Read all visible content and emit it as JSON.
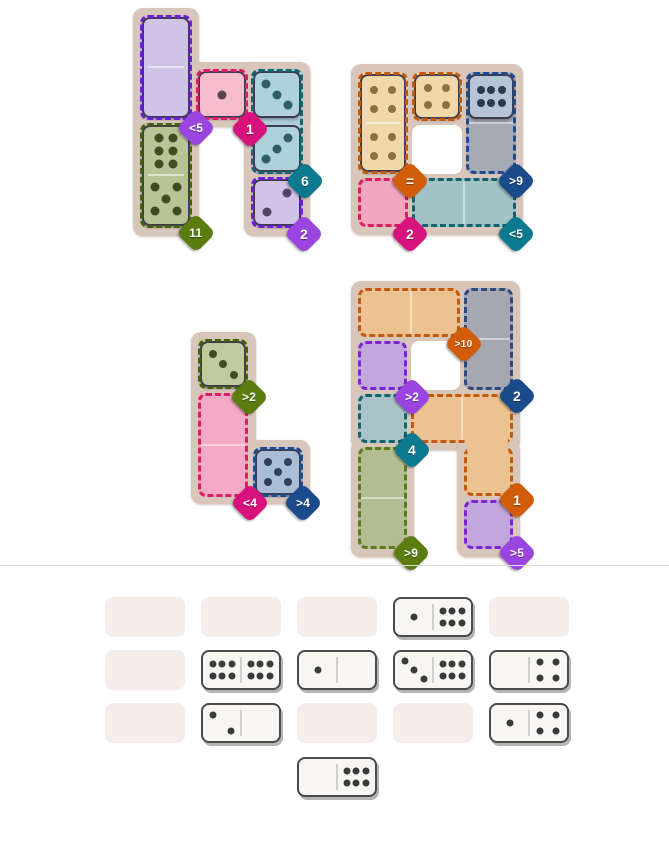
{
  "page": {
    "background": "#ffffff",
    "separator": {
      "y": 565,
      "color": "#dcdcdc"
    }
  },
  "badge_colors": {
    "purple": "#9b45e0",
    "magenta": "#d8127d",
    "teal": "#0b7a8e",
    "olive": "#5b7d10",
    "navy": "#1c4b8c",
    "orange": "#d15d0a"
  },
  "tile_outline": "#3e3a50",
  "frame_color": "#d9c6ba",
  "boards": [
    {
      "id": "top-left",
      "frame": [
        [
          133,
          8,
          66,
          228
        ],
        [
          189,
          62,
          121,
          65
        ],
        [
          244,
          62,
          66,
          174
        ]
      ],
      "regions": [
        {
          "id": "purple-top",
          "fill": "#cbbce6",
          "border": "#6d1fd0",
          "rects": [
            [
              140,
              15,
              52,
              105
            ]
          ],
          "dividers": []
        },
        {
          "id": "green",
          "fill": "#b7c293",
          "border": "#43610c",
          "rects": [
            [
              140,
              123,
              52,
              105
            ]
          ],
          "dividers": []
        },
        {
          "id": "pink",
          "fill": "#f5b3c8",
          "border": "#d81f5f",
          "rects": [
            [
              196,
              69,
              52,
              51
            ]
          ],
          "dividers": []
        },
        {
          "id": "teal",
          "fill": "#a9ced6",
          "border": "#13626e",
          "rects": [
            [
              251,
              69,
              52,
              105
            ]
          ],
          "dividers": []
        },
        {
          "id": "purple-bottom",
          "fill": "#cbbce6",
          "border": "#6d1fd0",
          "rects": [
            [
              251,
              177,
              52,
              51
            ]
          ],
          "dividers": []
        }
      ],
      "holes": [],
      "tiles": [
        {
          "x": 142,
          "y": 17,
          "w": 48,
          "h": 101,
          "fill": "#cfc3e8",
          "pip": "#4b4060",
          "divider": "h",
          "halves": [
            {
              "n": 0
            },
            {
              "n": 0
            }
          ]
        },
        {
          "x": 142,
          "y": 125,
          "w": 48,
          "h": 101,
          "fill": "#b9c396",
          "pip": "#3f4d24",
          "divider": "h",
          "halves": [
            {
              "n": 6,
              "layout": "6v"
            },
            {
              "n": 5
            }
          ]
        },
        {
          "x": 198,
          "y": 71,
          "w": 48,
          "h": 47,
          "fill": "#f6bccb",
          "pip": "#5c4150",
          "halves": [
            {
              "n": 1
            }
          ]
        },
        {
          "x": 253,
          "y": 71,
          "w": 48,
          "h": 47,
          "fill": "#add2d9",
          "pip": "#2f5f66",
          "halves": [
            {
              "n": 3
            }
          ]
        },
        {
          "x": 253,
          "y": 125,
          "w": 48,
          "h": 47,
          "fill": "#add2d9",
          "pip": "#2f5f66",
          "halves": [
            {
              "n": 3,
              "layout": "3b"
            }
          ]
        },
        {
          "x": 253,
          "y": 179,
          "w": 48,
          "h": 47,
          "fill": "#cfc3e8",
          "pip": "#514363",
          "halves": [
            {
              "n": 2,
              "layout": "2b"
            }
          ]
        }
      ],
      "badges": [
        {
          "label": "<5",
          "color": "purple",
          "x": 196,
          "y": 128
        },
        {
          "label": "1",
          "color": "magenta",
          "x": 250,
          "y": 129
        },
        {
          "label": "6",
          "color": "teal",
          "x": 305,
          "y": 181
        },
        {
          "label": "11",
          "color": "olive",
          "x": 196,
          "y": 233
        },
        {
          "label": "2",
          "color": "purple",
          "x": 304,
          "y": 234
        }
      ]
    },
    {
      "id": "top-right",
      "frame": [
        [
          351,
          64,
          172,
          171
        ]
      ],
      "regions": [
        {
          "id": "tan-left",
          "fill": "#eed6a4",
          "border": "#c05a10",
          "rects": [
            [
              358,
              72,
              50,
              102
            ]
          ],
          "dividers": []
        },
        {
          "id": "tan-top",
          "fill": "#eed6a4",
          "border": "#c05a10",
          "rects": [
            [
              412,
              72,
              50,
              49
            ]
          ],
          "dividers": []
        },
        {
          "id": "slate",
          "fill": "#a6aab5",
          "border": "#1d4b8f",
          "rects": [
            [
              466,
              72,
              50,
              102
            ]
          ],
          "dividers": [
            [
              468,
              122,
              46,
              2
            ]
          ]
        },
        {
          "id": "pink",
          "fill": "#f2a7c0",
          "border": "#d81f5f",
          "rects": [
            [
              358,
              178,
              50,
              49
            ]
          ],
          "dividers": []
        },
        {
          "id": "teal",
          "fill": "#a2c3c5",
          "border": "#13626e",
          "rects": [
            [
              412,
              178,
              104,
              49
            ]
          ],
          "dividers": [
            [
              463,
              181,
              2,
              43
            ]
          ]
        }
      ],
      "holes": [
        [
          412,
          125,
          50,
          49
        ]
      ],
      "tiles": [
        {
          "x": 360,
          "y": 74,
          "w": 46,
          "h": 98,
          "fill": "#f0d9a8",
          "pip": "#8a7243",
          "divider": "h",
          "halves": [
            {
              "n": 4
            },
            {
              "n": 4
            }
          ]
        },
        {
          "x": 414,
          "y": 74,
          "w": 46,
          "h": 45,
          "fill": "#f0d9a8",
          "pip": "#8a7243",
          "halves": [
            {
              "n": 4
            }
          ]
        },
        {
          "x": 468,
          "y": 74,
          "w": 46,
          "h": 45,
          "fill": "#b6c4d8",
          "pip": "#2c3a50",
          "halves": [
            {
              "n": 6,
              "layout": "6h"
            }
          ]
        }
      ],
      "badges": [
        {
          "label": "=",
          "color": "orange",
          "x": 410,
          "y": 181
        },
        {
          "label": ">9",
          "color": "navy",
          "x": 516,
          "y": 181
        },
        {
          "label": "2",
          "color": "magenta",
          "x": 410,
          "y": 234
        },
        {
          "label": "<5",
          "color": "teal",
          "x": 516,
          "y": 234
        }
      ]
    },
    {
      "id": "mid-left",
      "frame": [
        [
          191,
          332,
          65,
          172
        ],
        [
          246,
          440,
          64,
          64
        ]
      ],
      "regions": [
        {
          "id": "green",
          "fill": "#bdc79c",
          "border": "#43610c",
          "rects": [
            [
              198,
              339,
              50,
              50
            ]
          ],
          "dividers": []
        },
        {
          "id": "pink",
          "fill": "#f4a9c4",
          "border": "#d81f5f",
          "rects": [
            [
              198,
              393,
              50,
              104
            ]
          ],
          "dividers": [
            [
              200,
              444,
              46,
              2
            ]
          ]
        },
        {
          "id": "blue",
          "fill": "#a9bcd5",
          "border": "#1c4b8c",
          "rects": [
            [
              253,
              447,
              50,
              50
            ]
          ],
          "dividers": []
        }
      ],
      "holes": [],
      "tiles": [
        {
          "x": 200,
          "y": 341,
          "w": 46,
          "h": 46,
          "fill": "#bfcaa0",
          "pip": "#3f4d24",
          "halves": [
            {
              "n": 3
            }
          ]
        },
        {
          "x": 255,
          "y": 449,
          "w": 46,
          "h": 46,
          "fill": "#aabdd6",
          "pip": "#333f58",
          "halves": [
            {
              "n": 5
            }
          ]
        }
      ],
      "badges": [
        {
          "label": ">2",
          "color": "olive",
          "x": 249,
          "y": 397
        },
        {
          "label": "<4",
          "color": "magenta",
          "x": 250,
          "y": 503
        },
        {
          "label": ">4",
          "color": "navy",
          "x": 303,
          "y": 503
        }
      ]
    },
    {
      "id": "mid-right",
      "frame": [
        [
          351,
          281,
          169,
          169
        ],
        [
          351,
          440,
          63,
          117
        ],
        [
          457,
          440,
          63,
          117
        ]
      ],
      "regions": [
        {
          "id": "orange-top",
          "fill": "#edc291",
          "border": "#c05a10",
          "rects": [
            [
              358,
              288,
              102,
              49
            ]
          ],
          "dividers": [
            [
              410,
              291,
              2,
              43
            ]
          ]
        },
        {
          "id": "slate",
          "fill": "#a7a7b4",
          "border": "#2d4a7a",
          "rects": [
            [
              464,
              288,
              49,
              102
            ]
          ],
          "dividers": [
            [
              466,
              338,
              45,
              2
            ]
          ]
        },
        {
          "id": "purple-left",
          "fill": "#c2a7dc",
          "border": "#7d22d4",
          "rects": [
            [
              358,
              341,
              49,
              49
            ]
          ],
          "dividers": []
        },
        {
          "id": "teal",
          "fill": "#a8c4c8",
          "border": "#13626e",
          "rects": [
            [
              358,
              394,
              49,
              49
            ]
          ],
          "dividers": []
        },
        {
          "id": "orange-lower",
          "fill": "#edc291",
          "border": "#c05a10",
          "rects": [
            [
              411,
              394,
              102,
              49
            ],
            [
              464,
              447,
              49,
              49
            ]
          ],
          "dividers": [
            [
              461,
              397,
              2,
              43
            ]
          ],
          "patch": [
            467,
            438,
            41,
            14
          ]
        },
        {
          "id": "green",
          "fill": "#b4bd92",
          "border": "#5a7a1e",
          "rects": [
            [
              358,
              447,
              49,
              102
            ]
          ],
          "dividers": [
            [
              360,
              497,
              45,
              2
            ]
          ]
        },
        {
          "id": "purple-bottom",
          "fill": "#c2a7dc",
          "border": "#7d22d4",
          "rects": [
            [
              464,
              500,
              49,
              49
            ]
          ],
          "dividers": []
        }
      ],
      "holes": [
        [
          411,
          341,
          49,
          49
        ]
      ],
      "tiles": [],
      "badges": [
        {
          "label": ">10",
          "color": "orange",
          "x": 464,
          "y": 344
        },
        {
          "label": ">2",
          "color": "purple",
          "x": 412,
          "y": 397
        },
        {
          "label": "2",
          "color": "navy",
          "x": 517,
          "y": 396
        },
        {
          "label": "4",
          "color": "teal",
          "x": 412,
          "y": 450
        },
        {
          "label": "1",
          "color": "orange",
          "x": 517,
          "y": 500
        },
        {
          "label": ">9",
          "color": "olive",
          "x": 411,
          "y": 553
        },
        {
          "label": ">5",
          "color": "purple",
          "x": 517,
          "y": 553
        }
      ]
    }
  ],
  "tray": {
    "slot_fill": "#f5edea",
    "domino_bg": "#f7f6f3",
    "pip_color": "#3a3a3a",
    "cols_x": [
      105,
      201,
      297,
      393,
      489
    ],
    "rows_y": [
      597,
      650,
      703
    ],
    "slot_w": 80,
    "slot_h": 40,
    "grid": [
      [
        {
          "type": "empty"
        },
        {
          "type": "empty"
        },
        {
          "type": "empty"
        },
        {
          "type": "domino",
          "halves": [
            1,
            6
          ]
        },
        {
          "type": "empty"
        }
      ],
      [
        {
          "type": "empty"
        },
        {
          "type": "domino",
          "halves": [
            6,
            6
          ]
        },
        {
          "type": "domino",
          "halves": [
            1,
            0
          ]
        },
        {
          "type": "domino",
          "halves": [
            3,
            6
          ]
        },
        {
          "type": "domino",
          "halves": [
            0,
            4
          ]
        }
      ],
      [
        {
          "type": "empty"
        },
        {
          "type": "domino",
          "halves": [
            2,
            0
          ]
        },
        {
          "type": "empty"
        },
        {
          "type": "empty"
        },
        {
          "type": "domino",
          "halves": [
            1,
            4
          ]
        }
      ]
    ],
    "extra": {
      "type": "domino",
      "halves": [
        0,
        6
      ],
      "x": 297,
      "y": 757
    }
  }
}
